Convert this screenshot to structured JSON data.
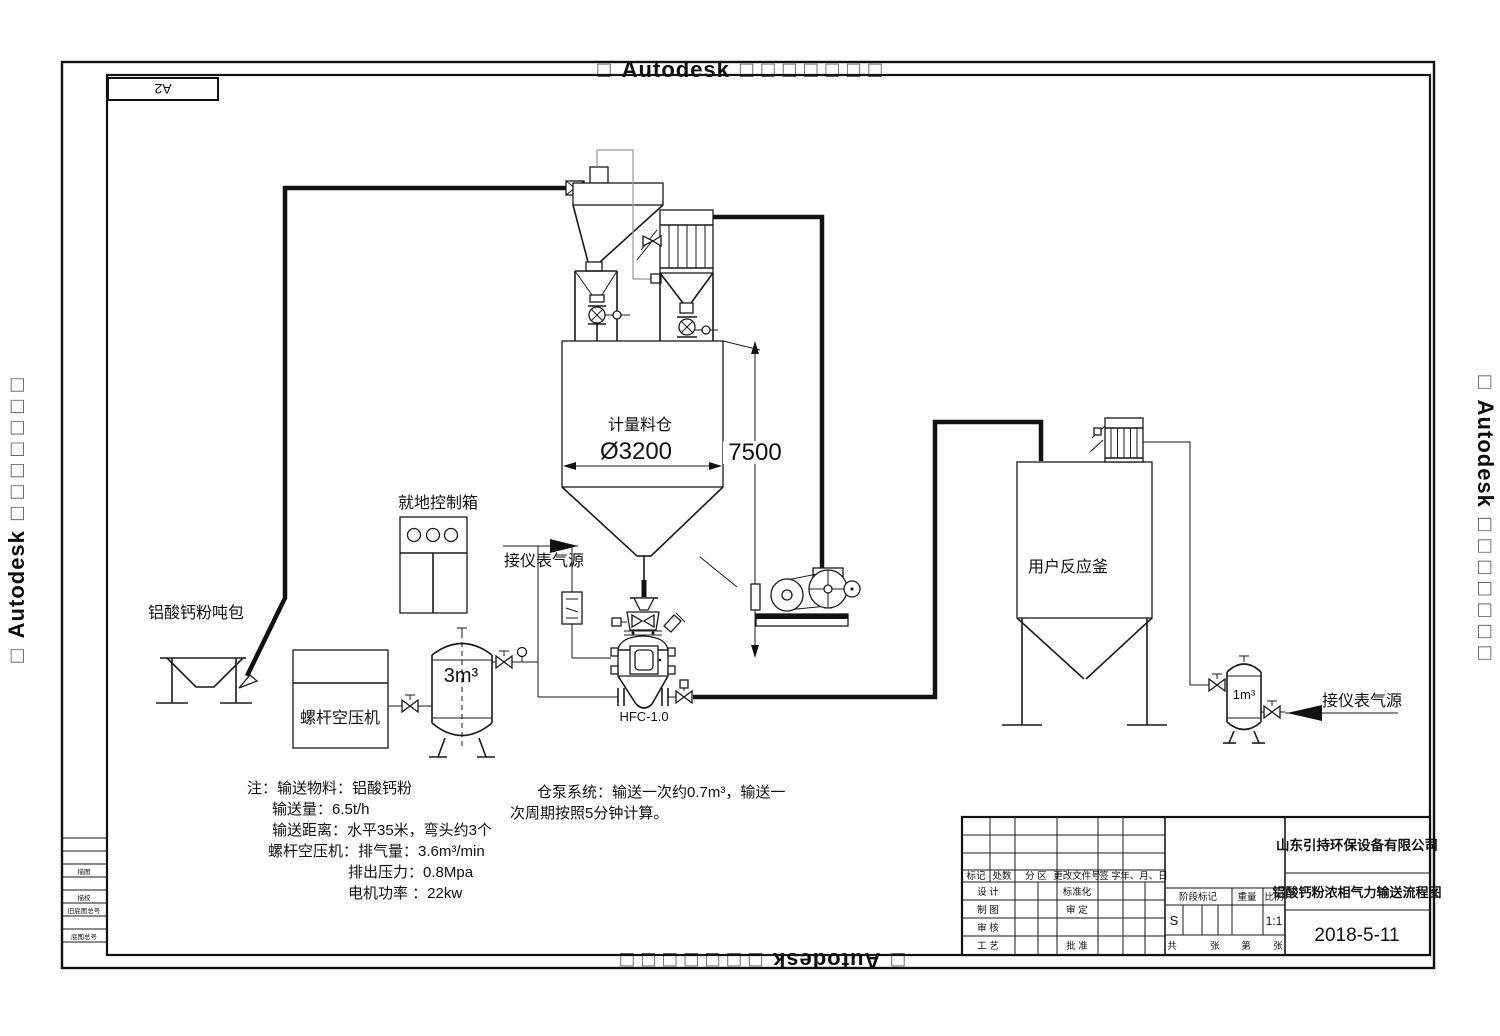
{
  "watermark": {
    "box_prefix": "□",
    "brand": "Autodesk",
    "box_suffix": "□ □ □ □ □ □ □"
  },
  "sheet": {
    "size_label": "A2"
  },
  "labels": {
    "ton_bag": "铝酸钙粉吨包",
    "control_box": "就地控制箱",
    "compressor": "螺杆空压机",
    "tank_3m3": "3m³",
    "silo": "计量料仓",
    "air_source_left": "接仪表气源",
    "air_source_right": "接仪表气源",
    "bin_pump_model": "HFC-1.0",
    "kettle": "用户反应釜",
    "tank_1m3": "1m³"
  },
  "dimensions": {
    "silo_diameter": "Ø3200",
    "silo_height": "7500"
  },
  "notes": {
    "lines": [
      "注：输送物料：铝酸钙粉",
      "输送量：6.5t/h",
      "输送距离：水平35米，弯头约3个",
      "螺杆空压机：排气量：3.6m³/min",
      "排出压力：0.8Mpa",
      "电机功率 ：22kw"
    ]
  },
  "pump_note": {
    "lines": [
      "仓泵系统：输送一次约0.7m³，输送一",
      "次周期按照5分钟计算。"
    ]
  },
  "title_block": {
    "company": "山东引持环保设备有限公司",
    "drawing_title": "铝酸钙粉浓相气力输送流程图",
    "date": "2018-5-11",
    "stage_mark": "S",
    "scale_value": "1:1",
    "header": [
      "标记",
      "处数",
      "分 区",
      "更改文件号",
      "签 字",
      "年、月、日"
    ],
    "left_rows": [
      "设 计",
      "制 图",
      "审 核",
      "工 艺"
    ],
    "mid_rows": [
      "标准化",
      "审 定",
      "批 准"
    ],
    "stage_header": [
      "阶段标记",
      "重量",
      "比例"
    ],
    "sheet_row": [
      "共",
      "张",
      "第",
      "张"
    ]
  },
  "margin_table": {
    "rows": [
      "描图",
      "描校",
      "旧底图总号",
      "底图总号"
    ]
  }
}
